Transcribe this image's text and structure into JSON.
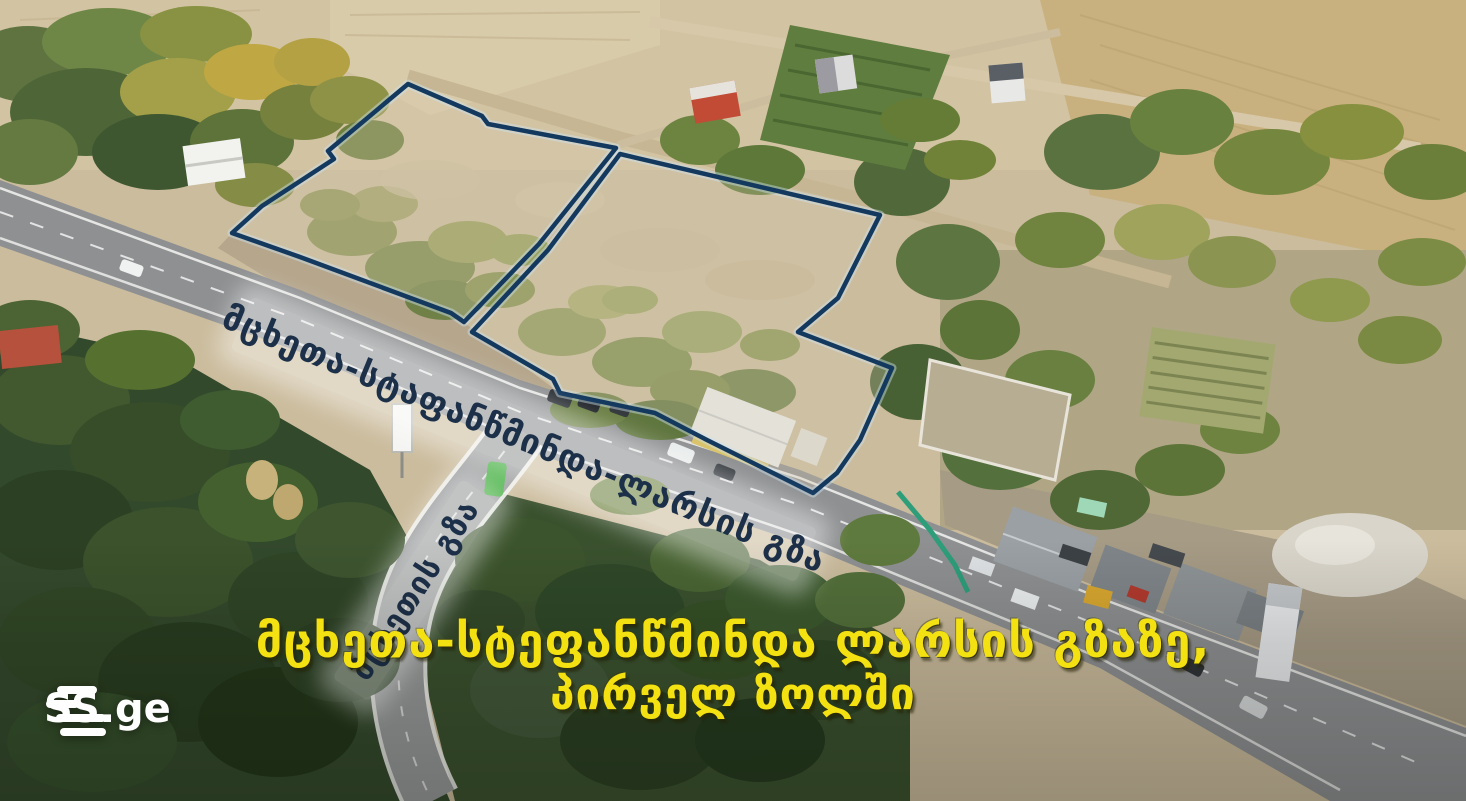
{
  "branding": {
    "logo_text": "SS.ge"
  },
  "overlays": {
    "main_road_label": "მცხეთა-სტაფანწმინდა-ლარსის გზა",
    "side_road_label": "მცხეთის გზა",
    "caption_line1": "მცხეთა-სტეფანწმინდა ლარსის გზაზე,",
    "caption_line2": "პირველ ზოლში",
    "caption_color": "#f3e112",
    "outline_color": "#14395f"
  },
  "plots": {
    "left": {
      "points": "408,84 482,116 488,124 616,148 539,244 464,322 451,313 300,257 232,233 262,206 334,159 328,151"
    },
    "right": {
      "points": "620,154 880,215 838,298 798,332 892,368 860,440 837,473 813,493 767,470 707,440 655,413 560,393 553,379 472,332 548,250"
    }
  }
}
